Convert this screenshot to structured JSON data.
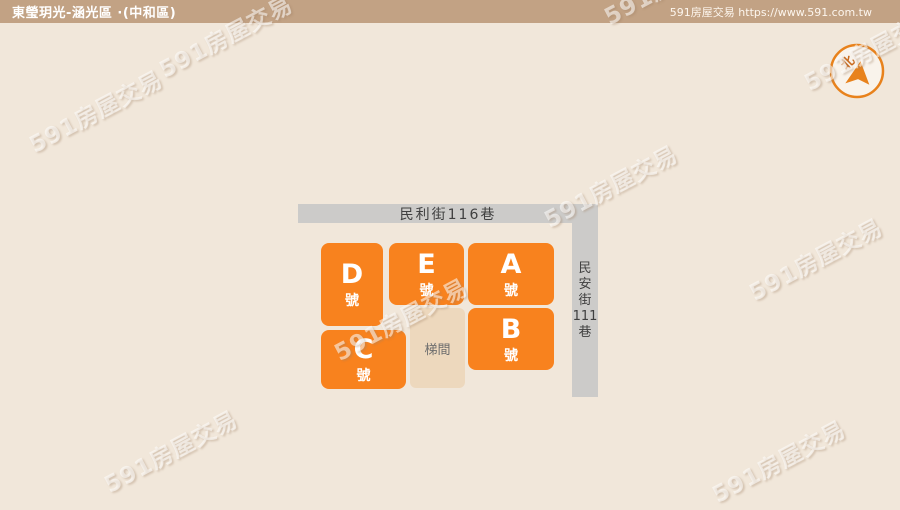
{
  "header": {
    "title": "東瑩玥光-涵光區 ·(中和區)",
    "site": "591房屋交易 https://www.591.com.tw"
  },
  "watermark": {
    "text": "591房屋交易"
  },
  "compass": {
    "north_label": "北"
  },
  "colors": {
    "header_bg": "#c2a284",
    "canvas_bg": "#f1e7da",
    "unit_orange": "#f8821e",
    "street_gray": "#cccbc9",
    "stair_tan": "#edd8bd",
    "compass_orange": "#e8821c"
  },
  "plan": {
    "streets": [
      {
        "label": "民利街116巷",
        "orientation": "horizontal"
      },
      {
        "label": "民安街111巷",
        "orientation": "vertical",
        "chars": [
          "民",
          "安",
          "街",
          "111",
          "巷"
        ]
      }
    ],
    "units": [
      {
        "letter": "D",
        "suffix": "號"
      },
      {
        "letter": "E",
        "suffix": "號"
      },
      {
        "letter": "A",
        "suffix": "號"
      },
      {
        "letter": "B",
        "suffix": "號"
      },
      {
        "letter": "C",
        "suffix": "號"
      }
    ],
    "stairwell": {
      "label": "梯間"
    }
  }
}
